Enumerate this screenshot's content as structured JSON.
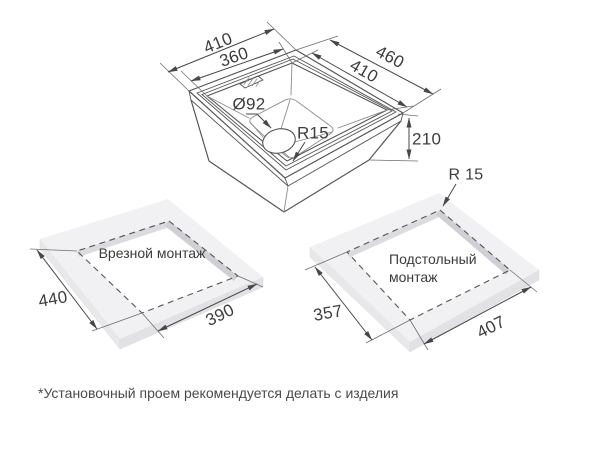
{
  "drawing": {
    "sink": {
      "dim_outer_width": "410",
      "dim_inner_width": "360",
      "dim_outer_depth": "460",
      "dim_inner_depth": "410",
      "dim_height": "210",
      "dim_drain_diameter": "Ø92",
      "dim_corner_radius": "R15"
    },
    "inset_mount": {
      "title": "Врезной монтаж",
      "dim_width": "440",
      "dim_depth": "390"
    },
    "undermount": {
      "title_line1": "Подстольный",
      "title_line2": "монтаж",
      "dim_corner_radius": "R 15",
      "dim_width": "357",
      "dim_depth": "407"
    },
    "footnote": "*Установочный проем рекомендуется делать с изделия"
  },
  "colors": {
    "background": "#ffffff",
    "outline": "#565656",
    "dimension_line": "#474747",
    "text": "#3d3d3d",
    "slab_top": "#f1f1f3",
    "slab_side_left": "#e8e8eb",
    "slab_side_front": "#e2e2e6",
    "cutout_shadow_light": "#dcdce0",
    "cutout_shadow_dark": "#cfcfd5",
    "footnote_text": "#4a4a4a"
  }
}
